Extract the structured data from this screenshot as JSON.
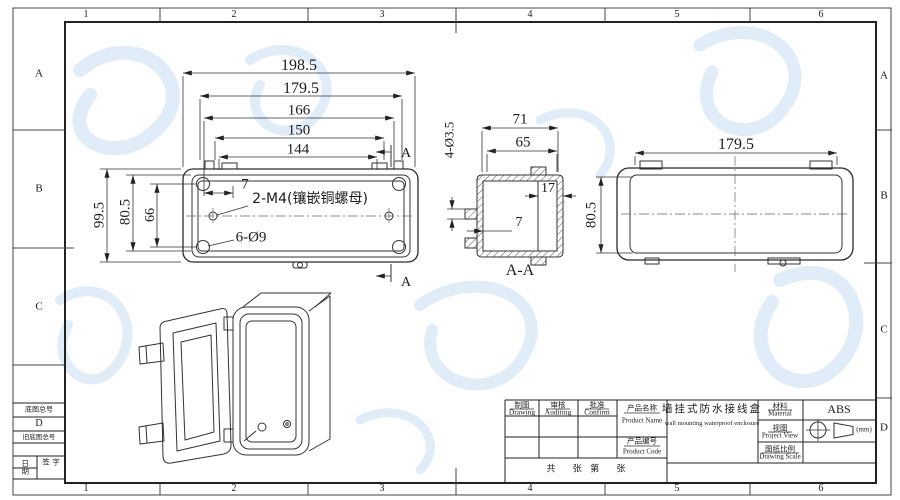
{
  "page": {
    "background": "#ffffff",
    "line_color": "#2b2b2b",
    "watermark_color": "#cfe2f4"
  },
  "border": {
    "zones_top": [
      "1",
      "2",
      "3",
      "4",
      "5",
      "6"
    ],
    "zones_bottom": [
      "1",
      "2",
      "3",
      "4",
      "5",
      "6"
    ],
    "zones_left": [
      "A",
      "B",
      "C"
    ],
    "zones_right": [
      "A",
      "B",
      "C",
      "D"
    ]
  },
  "margin_blocks": {
    "base_drawing_no": "底图总号",
    "zone_letter": "D",
    "old_base_drawing_no": "旧底图总号",
    "date": "日期",
    "signature": "签 字"
  },
  "front_view": {
    "dim_overall_w": "198.5",
    "dim_lid_w": "179.5",
    "dim_tab_w": "166",
    "dim_hole_w": "150",
    "dim_inner_w": "144",
    "dim_post": "7",
    "note_m4": "2-M4(镶嵌铜螺母)",
    "note_holes": "6-Ø9",
    "dim_overall_h": "99.5",
    "dim_lid_h": "80.5",
    "dim_hole_h": "66",
    "section_mark": "A"
  },
  "section_view": {
    "label": "A-A",
    "dim_depth_overall": "71",
    "dim_body_depth": "65",
    "dim_tab_holes": "4-Ø3.5",
    "dim_inner_depth": "17",
    "dim_tab": "7"
  },
  "side_view": {
    "dim_width": "179.5",
    "dim_height": "80.5"
  },
  "title_block": {
    "drawing_zh": "制图",
    "drawing_en": "Drawing",
    "auditing_zh": "审核",
    "auditing_en": "Auditing",
    "confirm_zh": "批准",
    "confirm_en": "Confirm",
    "product_name_label_zh": "产品名称",
    "product_name_label_en": "Product Name",
    "product_code_label_zh": "产品编号",
    "product_code_label_en": "Product Code",
    "product_name_zh": "墙挂式防水接线盒",
    "product_name_en": "wall mounting waterproof enclosure",
    "material_zh": "材料",
    "material_en": "Material",
    "material_value": "ABS",
    "view_zh": "视图",
    "view_en": "Project View",
    "unit": "(mm)",
    "scale_zh": "图纸比例",
    "scale_en": "Drawing Scale",
    "sheet_text": "共      张   第      张"
  }
}
